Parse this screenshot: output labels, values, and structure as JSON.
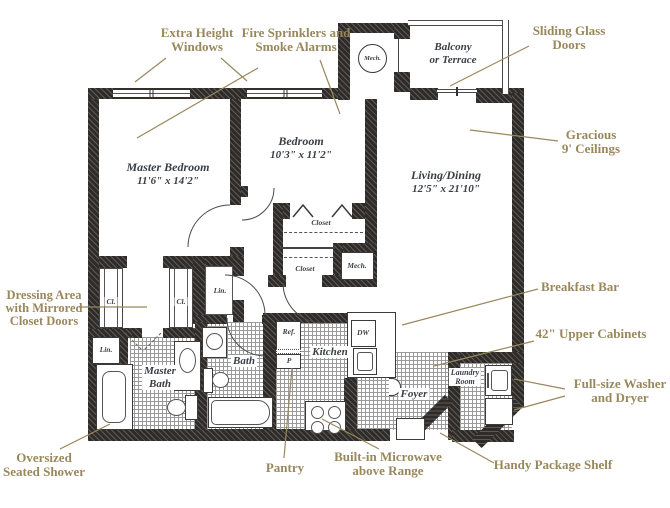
{
  "title": "Two-bedroom apartment floor plan",
  "colors": {
    "annotation_gold": "#99885c",
    "room_label": "#3a3e45",
    "wall": "#2e2b28"
  },
  "annotations": {
    "extra_height_windows": {
      "line1": "Extra Height",
      "line2": "Windows"
    },
    "fire_sprinklers": {
      "line1": "Fire Sprinklers and",
      "line2": "Smoke Alarms"
    },
    "sliding_glass_doors": {
      "line1": "Sliding Glass",
      "line2": "Doors"
    },
    "gracious_ceilings": {
      "line1": "Gracious",
      "line2": "9' Ceilings"
    },
    "breakfast_bar": {
      "line1": "Breakfast Bar"
    },
    "upper_cabinets": {
      "line1": "42\" Upper Cabinets"
    },
    "washer_dryer": {
      "line1": "Full-size Washer",
      "line2": "and Dryer"
    },
    "handy_package_shelf": {
      "line1": "Handy Package Shelf"
    },
    "built_in_microwave": {
      "line1": "Built-in Microwave",
      "line2": "above Range"
    },
    "pantry": {
      "line1": "Pantry"
    },
    "oversized_shower": {
      "line1": "Oversized",
      "line2": "Seated Shower"
    },
    "dressing_area": {
      "line1": "Dressing Area",
      "line2": "with Mirrored",
      "line3": "Closet Doors"
    }
  },
  "rooms": {
    "master_bedroom": {
      "name": "Master Bedroom",
      "dims": "11'6\" x 14'2\""
    },
    "bedroom": {
      "name": "Bedroom",
      "dims": "10'3\" x 11'2\""
    },
    "living_dining": {
      "name": "Living/Dining",
      "dims": "12'5\" x 21'10\""
    },
    "balcony": {
      "line1": "Balcony",
      "line2": "or Terrace"
    },
    "master_bath": {
      "line1": "Master",
      "line2": "Bath"
    },
    "bath": {
      "name": "Bath"
    },
    "kitchen": {
      "name": "Kitchen"
    },
    "foyer": {
      "name": "Foyer"
    },
    "laundry": {
      "line1": "Laundry",
      "line2": "Room"
    }
  },
  "small_labels": {
    "mech_upper": "Mech.",
    "mech_lower": "Mech.",
    "closet_upper": "Closet",
    "closet_lower": "Closet",
    "cl_left": "Cl.",
    "cl_right": "Cl.",
    "lin_hall": "Lin.",
    "lin_bath": "Lin.",
    "ref": "Ref.",
    "dw": "DW",
    "pantry_p": "P"
  }
}
